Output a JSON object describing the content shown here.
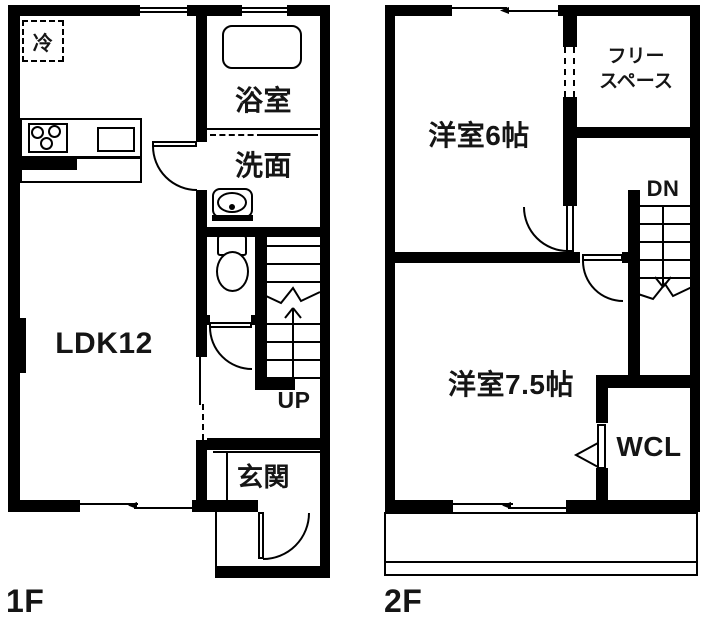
{
  "floor1": {
    "label": "1F",
    "rooms": {
      "fridge": "冷",
      "bath": "浴室",
      "wash": "洗面",
      "ldk": "LDK12",
      "stairs": "UP",
      "entrance": "玄関"
    }
  },
  "floor2": {
    "label": "2F",
    "rooms": {
      "room6": "洋室6帖",
      "free_line1": "フリー",
      "free_line2": "スペース",
      "stairs": "DN",
      "room75": "洋室7.5帖",
      "wcl": "WCL"
    }
  },
  "colors": {
    "wall": "#000000",
    "background": "#ffffff"
  }
}
